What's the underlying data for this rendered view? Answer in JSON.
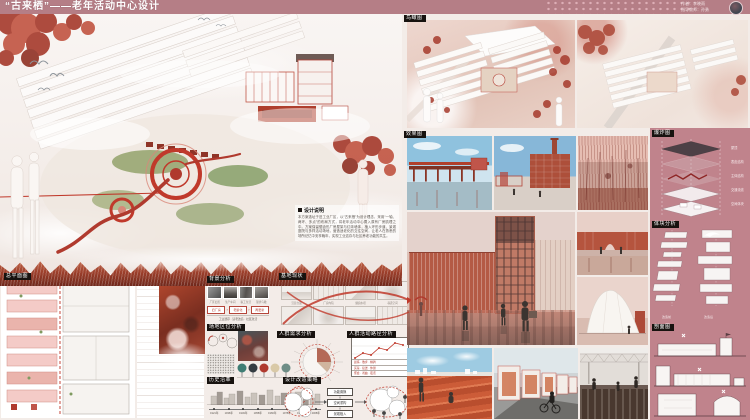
{
  "poster": {
    "title": "“古来栖”——老年活动中心设计",
    "credits": {
      "author": "作者：李晓雨",
      "advisor": "指导教师：孙勇"
    }
  },
  "labels": {
    "site_plan": "总平面图",
    "background": "背景分析",
    "location": "场地区位分析",
    "history": "历史沿革",
    "site_status": "基地现状",
    "needs": "人群需求分析",
    "activity_path": "人群活动路径分析",
    "strategy": "设计改造策略",
    "bird_view": "鸟瞰图",
    "renders": "效果图",
    "exploded": "爆炸图",
    "massing": "体块分析",
    "sections": "剖面图"
  },
  "design_note": {
    "title": "设计说明",
    "body": "本方案选址于旧工业厂区，以“古来栖”为设计理念，采用“一轴、两环、多点”的布局方式，将老年活动中心置入原有厂房肌理之中。方案保留锯齿形厂房屋架与红砖墙体，植入环形步道、景观庭院与多样活动场地，营造适老化的交往空间，让老人在熟悉的场所记忆中安享晚年，实现工业遗存与社区养老功能的共生。"
  },
  "background_flow": [
    "旧厂房",
    "老龄化",
    "再更新"
  ],
  "background_photo_captions": [
    "厂区旧照",
    "生产车间",
    "职工生活",
    "现状鸟瞰"
  ],
  "background_caption": "工业遗存 · 适老改造 · 社区激活",
  "history_timeline": [
    "1921年",
    "1936年",
    "1949年",
    "1958年",
    "1966年",
    "1978年",
    "1992年",
    "2008年"
  ],
  "sketch_captions": [
    "沿街立面",
    "厂房内院",
    "烟囱水塔",
    "巷道空间"
  ],
  "path_chart_rows": [
    "晨练 · 散步 · 棋牌",
    "买菜 · 接送 · 休憩",
    "聚会 · 戏曲 · 夜话"
  ],
  "strategy_boxes": [
    "功能置换",
    "空间重构",
    "景观植入"
  ],
  "exploded_layers": [
    "屋顶",
    "表皮结构",
    "主体结构",
    "交通流线",
    "空间体块"
  ],
  "massing_captions": {
    "before": "改造前",
    "after": "改造后"
  },
  "colors": {
    "accent_red": "#c0392b",
    "header": "#b57e86",
    "panel": "#c0838c"
  }
}
